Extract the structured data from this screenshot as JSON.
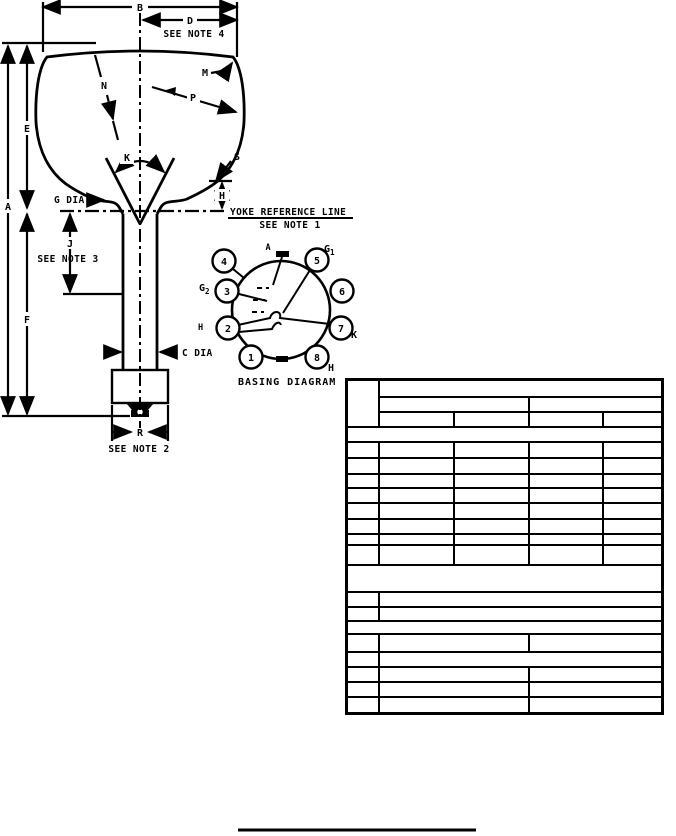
{
  "page": {
    "paper_color": "#ffffff",
    "ink_color": "#000000"
  },
  "outline_drawing": {
    "dimension_labels": {
      "B": "B",
      "D": "D",
      "A": "A",
      "E": "E",
      "F": "F",
      "J": "J",
      "H": "H",
      "K": "K",
      "M": "M",
      "N": "N",
      "P": "P",
      "R": "R",
      "S": "S",
      "G_DIA": "G DIA",
      "C_DIA": "C DIA"
    },
    "notes": {
      "see_note_4": "SEE NOTE 4",
      "yoke_reference_line": "YOKE REFERENCE LINE",
      "see_note_1": "SEE NOTE 1",
      "see_note_3": "SEE NOTE 3",
      "see_note_2": "SEE NOTE 2"
    }
  },
  "basing_diagram": {
    "title": "BASING DIAGRAM",
    "pin_numbers": [
      "1",
      "2",
      "3",
      "4",
      "5",
      "6",
      "7",
      "8"
    ],
    "electrode_labels": {
      "anode": "A",
      "g1_base": "G",
      "g1_sub": "1",
      "g2_base": "G",
      "g2_sub": "2",
      "cathode": "K",
      "heater_pin8": "H",
      "heater_pin2": "H"
    }
  },
  "table": {
    "all_cells_blank": true,
    "col_widths": [
      32,
      75,
      75,
      74,
      60
    ],
    "rows": [
      {
        "h": 17,
        "cells": [
          [
            1,
            3
          ],
          [
            4,
            1
          ]
        ]
      },
      {
        "h": 15,
        "cells": [
          [
            2,
            1
          ],
          [
            2,
            1
          ]
        ]
      },
      {
        "h": 15,
        "cells": [
          [
            1,
            1
          ],
          [
            1,
            1
          ],
          [
            1,
            1
          ],
          [
            1,
            1
          ]
        ]
      },
      {
        "h": 15,
        "cells": [
          [
            5,
            1
          ]
        ]
      },
      {
        "h": 16,
        "cells": [
          [
            1,
            1
          ],
          [
            1,
            1
          ],
          [
            1,
            1
          ],
          [
            1,
            1
          ],
          [
            1,
            1
          ]
        ]
      },
      {
        "h": 16,
        "cells": [
          [
            1,
            1
          ],
          [
            1,
            1
          ],
          [
            1,
            1
          ],
          [
            1,
            1
          ],
          [
            1,
            1
          ]
        ]
      },
      {
        "h": 14,
        "cells": [
          [
            1,
            1
          ],
          [
            1,
            1
          ],
          [
            1,
            1
          ],
          [
            1,
            1
          ],
          [
            1,
            1
          ]
        ]
      },
      {
        "h": 15,
        "cells": [
          [
            1,
            1
          ],
          [
            1,
            1
          ],
          [
            1,
            1
          ],
          [
            1,
            1
          ],
          [
            1,
            1
          ]
        ]
      },
      {
        "h": 16,
        "cells": [
          [
            1,
            1
          ],
          [
            1,
            1
          ],
          [
            1,
            1
          ],
          [
            1,
            1
          ],
          [
            1,
            1
          ]
        ]
      },
      {
        "h": 15,
        "cells": [
          [
            1,
            1
          ],
          [
            1,
            1
          ],
          [
            1,
            1
          ],
          [
            1,
            1
          ],
          [
            1,
            1
          ]
        ]
      },
      {
        "h": 11,
        "cells": [
          [
            1,
            1
          ],
          [
            1,
            1
          ],
          [
            1,
            1
          ],
          [
            1,
            1
          ],
          [
            1,
            1
          ]
        ]
      },
      {
        "h": 20,
        "cells": [
          [
            1,
            1
          ],
          [
            1,
            1
          ],
          [
            1,
            1
          ],
          [
            1,
            1
          ],
          [
            1,
            1
          ]
        ]
      },
      {
        "h": 27,
        "cells": [
          [
            5,
            1
          ]
        ]
      },
      {
        "h": 15,
        "cells": [
          [
            1,
            1
          ],
          [
            4,
            1
          ]
        ]
      },
      {
        "h": 14,
        "cells": [
          [
            1,
            1
          ],
          [
            4,
            1
          ]
        ]
      },
      {
        "h": 13,
        "cells": [
          [
            5,
            1
          ]
        ]
      },
      {
        "h": 18,
        "cells": [
          [
            1,
            1
          ],
          [
            2,
            1
          ],
          [
            2,
            1
          ]
        ]
      },
      {
        "h": 15,
        "cells": [
          [
            1,
            1
          ],
          [
            4,
            1
          ]
        ]
      },
      {
        "h": 15,
        "cells": [
          [
            1,
            1
          ],
          [
            2,
            1
          ],
          [
            2,
            1
          ]
        ]
      },
      {
        "h": 15,
        "cells": [
          [
            1,
            1
          ],
          [
            2,
            1
          ],
          [
            2,
            1
          ]
        ]
      },
      {
        "h": 17,
        "cells": [
          [
            1,
            1
          ],
          [
            2,
            1
          ],
          [
            2,
            1
          ]
        ]
      }
    ]
  }
}
